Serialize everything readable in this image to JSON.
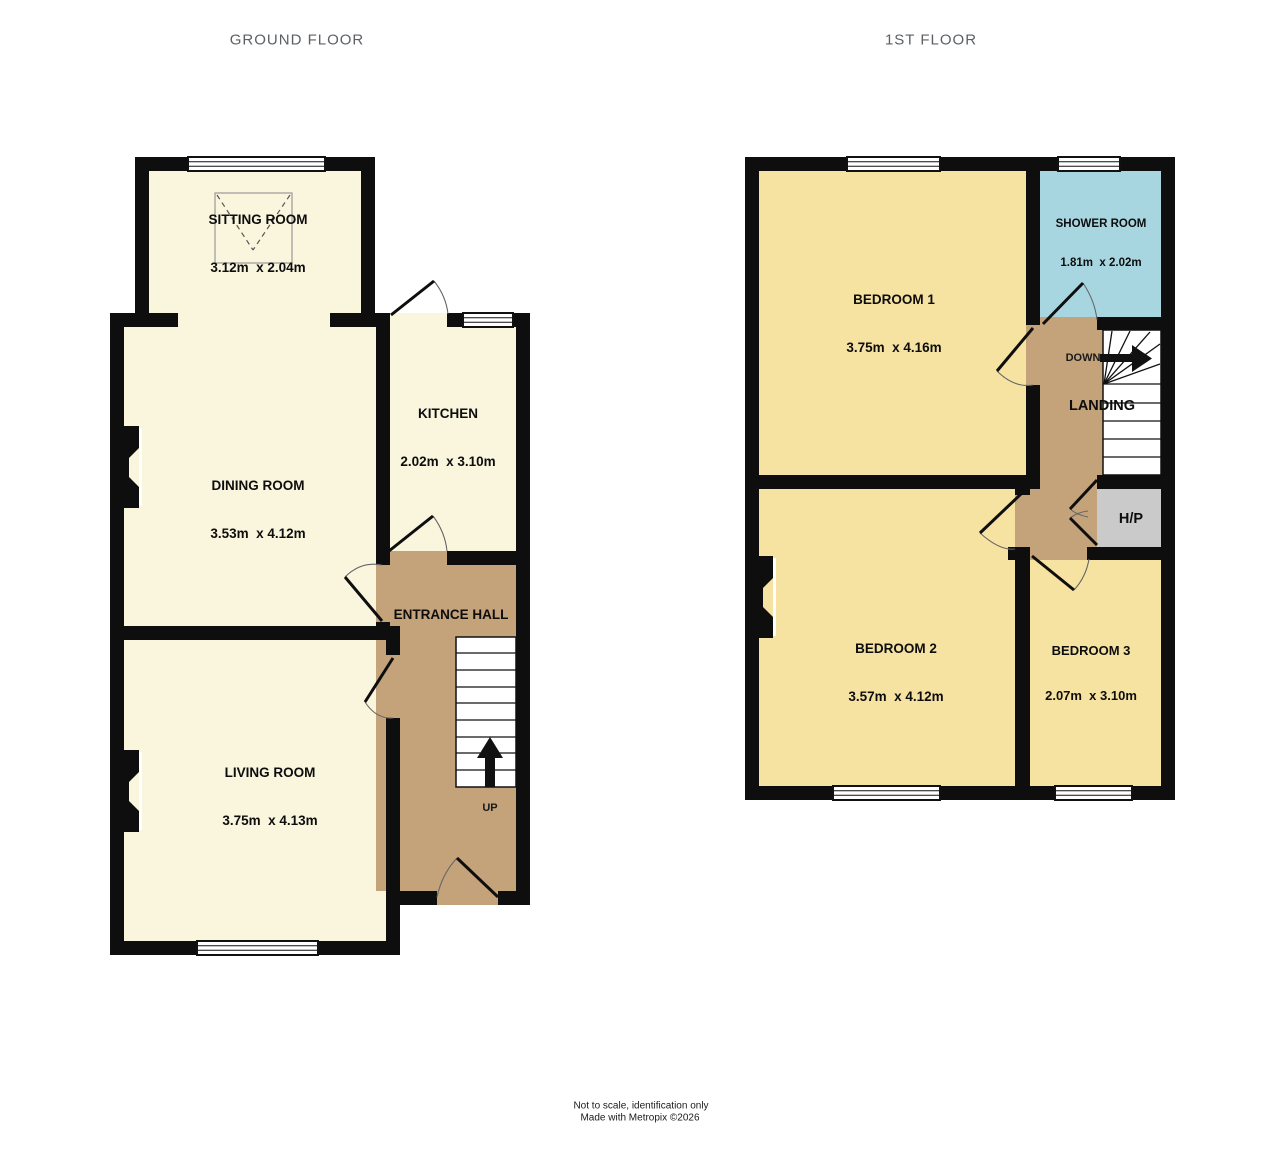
{
  "colors": {
    "wall": "#0e0e0e",
    "ground_room": "#FAF6DE",
    "first_room": "#F6E3A2",
    "hall": "#C4A37B",
    "shower": "#A8D6E0",
    "cupboard": "#CACACA",
    "window_fill": "#FFFFFF",
    "stairs_fill": "#FFFFFF"
  },
  "ground_floor": {
    "title": "GROUND FLOOR",
    "rooms": {
      "sitting_room": {
        "name": "SITTING ROOM",
        "dims": "3.12m  x 2.04m"
      },
      "dining_room": {
        "name": "DINING ROOM",
        "dims": "3.53m  x 4.12m"
      },
      "kitchen": {
        "name": "KITCHEN",
        "dims": "2.02m  x 3.10m"
      },
      "entrance_hall": {
        "name": "ENTRANCE HALL"
      },
      "living_room": {
        "name": "LIVING ROOM",
        "dims": "3.75m  x 4.13m"
      }
    },
    "stair_label": "UP"
  },
  "first_floor": {
    "title": "1ST FLOOR",
    "rooms": {
      "bedroom_1": {
        "name": "BEDROOM 1",
        "dims": "3.75m  x 4.16m"
      },
      "shower_room": {
        "name": "SHOWER ROOM",
        "dims": "1.81m  x 2.02m"
      },
      "landing": {
        "name": "LANDING"
      },
      "hot_press": {
        "name": "H/P"
      },
      "bedroom_2": {
        "name": "BEDROOM 2",
        "dims": "3.57m  x 4.12m"
      },
      "bedroom_3": {
        "name": "BEDROOM 3",
        "dims": "2.07m  x 3.10m"
      }
    },
    "stair_label": "DOWN"
  },
  "footer": {
    "line1": "Not to scale, identification only",
    "line2": "Made with Metropix ©2026"
  }
}
